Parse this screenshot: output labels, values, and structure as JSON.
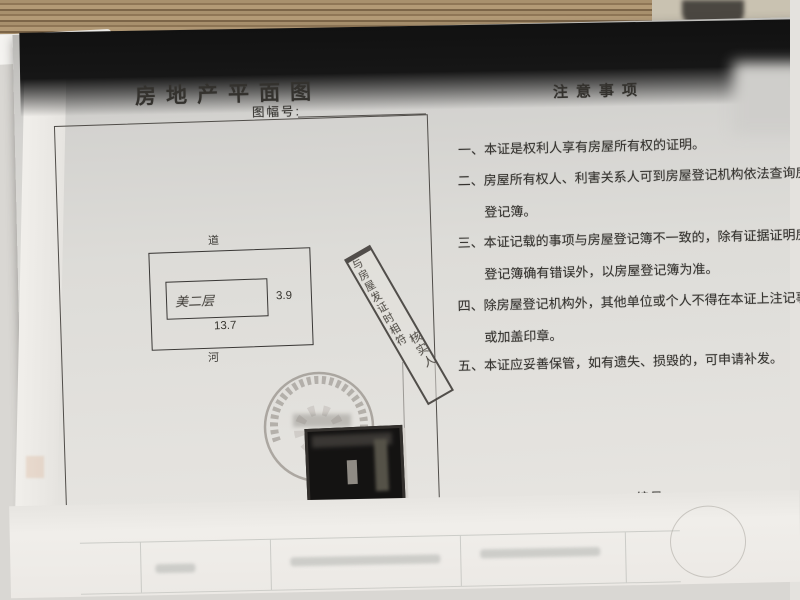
{
  "document": {
    "title": "房地产平面图",
    "sheet_no_label": "图幅号:",
    "plan": {
      "road_label": "道",
      "river_label": "河",
      "building_label": "美二层",
      "height_dim": "3.9",
      "width_dim": "13.7",
      "scale_label": "比例尺",
      "scale_value": "1:"
    },
    "strip_stamp": {
      "line1": "与房屋发证时相符",
      "line2": "核实人"
    },
    "notices": {
      "title": "注意事项",
      "items": [
        "一、本证是权利人享有房屋所有权的证明。",
        "二、房屋所有权人、利害关系人可到房屋登记机构依法查询房屋登记簿。",
        "三、本证记载的事项与房屋登记簿不一致的，除有证据证明房屋登记簿确有错误外，以房屋登记簿为准。",
        "四、除房屋登记机构外，其他单位或个人不得在本证上注记事项或加盖印章。",
        "五、本证应妥善保管，如有遗失、损毁的，可申请补发。"
      ]
    },
    "serial_label": "编号："
  },
  "colors": {
    "desk_wood": "#9a8164",
    "scan_band": "#161616",
    "page_gray": "#d9d8d4",
    "paper_white": "#f0eeea",
    "ink": "#34322e"
  }
}
